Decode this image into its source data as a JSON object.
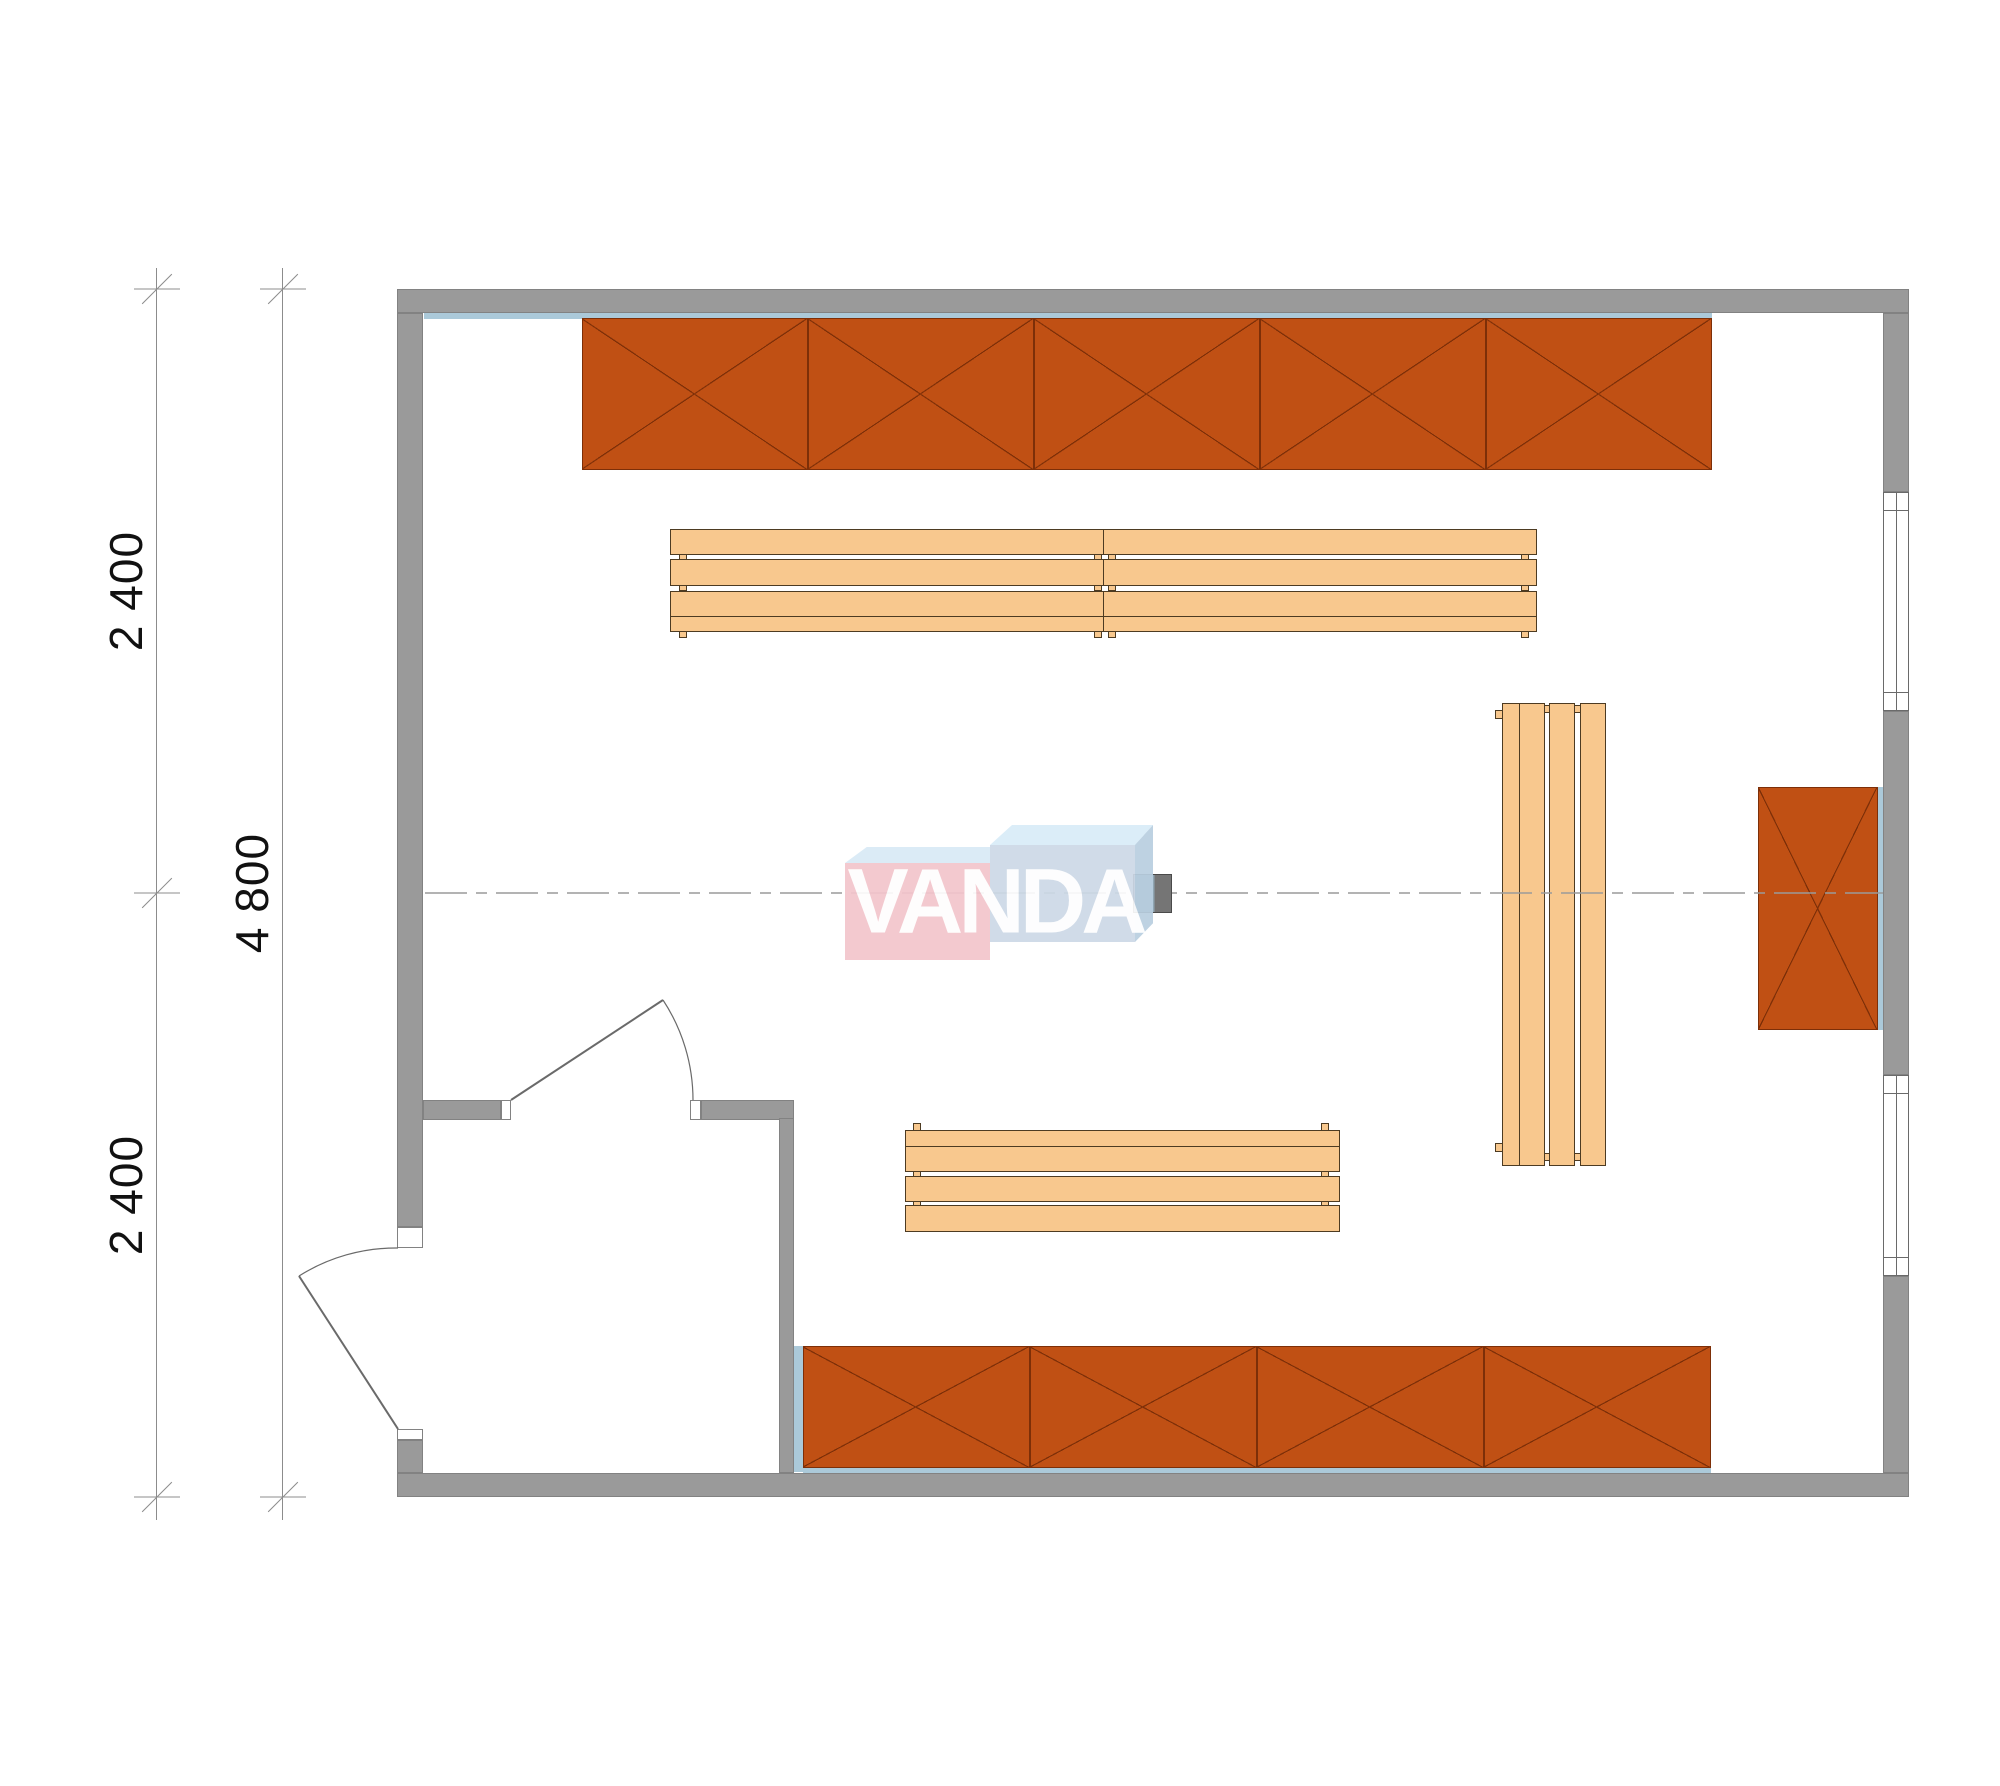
{
  "drawing": {
    "type": "architectural floor plan, top view",
    "watermark": "VANDA",
    "dimension_labels": {
      "segment_top": "2 400",
      "overall": "4 800",
      "segment_bottom": "2 400"
    },
    "inventory": {
      "cabinet_runs": 3,
      "top_cabinet_compartments": 5,
      "bottom_cabinet_compartments": 4,
      "right_wall_cabinet_compartments": 1,
      "benches": 3,
      "slats_per_bench": 4,
      "windows": 2,
      "doors": 2,
      "heater_units": 1,
      "vestibule_rooms": 1
    }
  },
  "colors": {
    "paper": "#ffffff",
    "wall": "#9a9a9a",
    "wallline": "#828282",
    "lining": "#abc9d9",
    "cab": "#c05014",
    "cabline": "#7d2f08",
    "bench": "#f8c88e",
    "benchline": "#4d3b22",
    "dimcol": "#8c8c8c",
    "textcol": "#111111",
    "doorcol": "#6a6a6a",
    "centercol": "#9a9a9a",
    "pink": "#f3c5cc",
    "bluefront": "#cdd9e7",
    "bluetop": "#d8ecf8",
    "paletop": "#d8eaf6",
    "blueside": "#b9cfe0",
    "heaterA": "#8fa5b2",
    "heaterB": "#757575"
  }
}
